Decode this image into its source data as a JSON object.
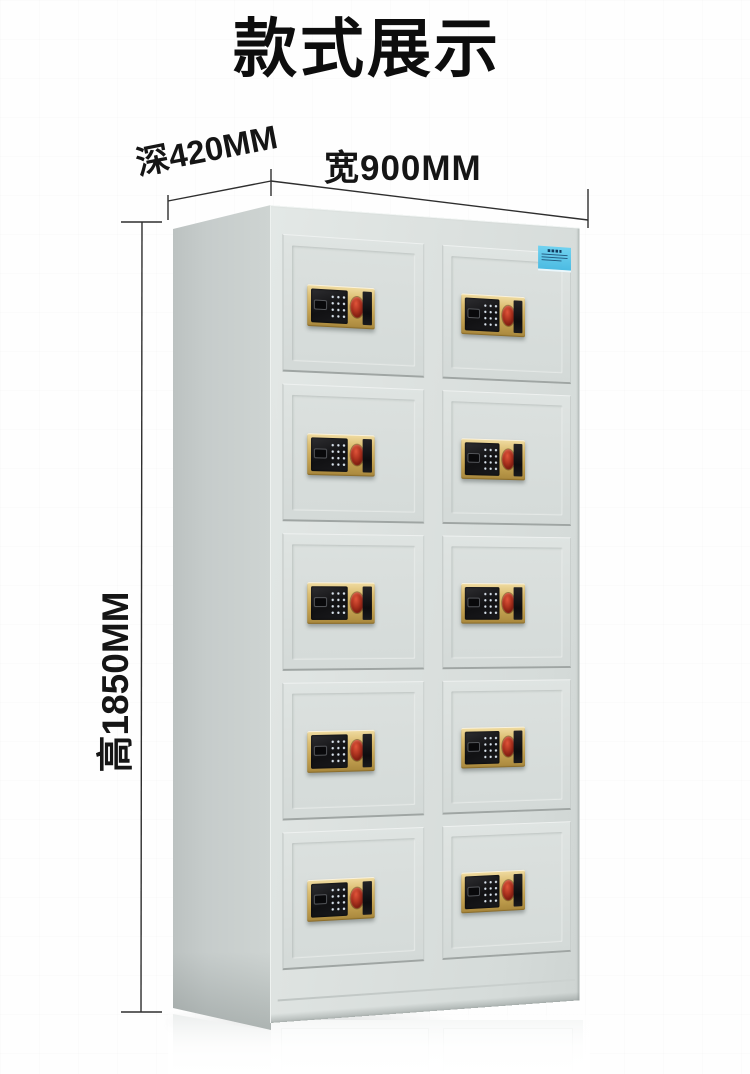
{
  "page_title": "款式展示",
  "dimensions": {
    "depth_label": "深420MM",
    "width_label": "宽900MM",
    "height_label": "高1850MM"
  },
  "cabinet": {
    "kind": "electronic-fingerprint-locker-cabinet",
    "rows": 5,
    "columns": 2,
    "door_count": 10,
    "doors": [
      {
        "row": 1,
        "col": 1
      },
      {
        "row": 1,
        "col": 2
      },
      {
        "row": 2,
        "col": 1
      },
      {
        "row": 2,
        "col": 2
      },
      {
        "row": 3,
        "col": 1
      },
      {
        "row": 3,
        "col": 2
      },
      {
        "row": 4,
        "col": 1
      },
      {
        "row": 4,
        "col": 2
      },
      {
        "row": 5,
        "col": 1
      },
      {
        "row": 5,
        "col": 2
      }
    ],
    "lock_parts": [
      "keypad-panel",
      "display-window",
      "keypad-dots",
      "fingerprint-sensor",
      "key-cover"
    ],
    "sticker_color": "#4fc0e8"
  },
  "colors": {
    "background": "#fefefe",
    "cabinet_body": "#d8dedc",
    "cabinet_side": "#c6cccb",
    "lock_gold": "#c7a654",
    "lock_black": "#141416",
    "sensor_red": "#a83320",
    "dimension_line": "#2e2e2e",
    "text": "#0d0d0d"
  }
}
